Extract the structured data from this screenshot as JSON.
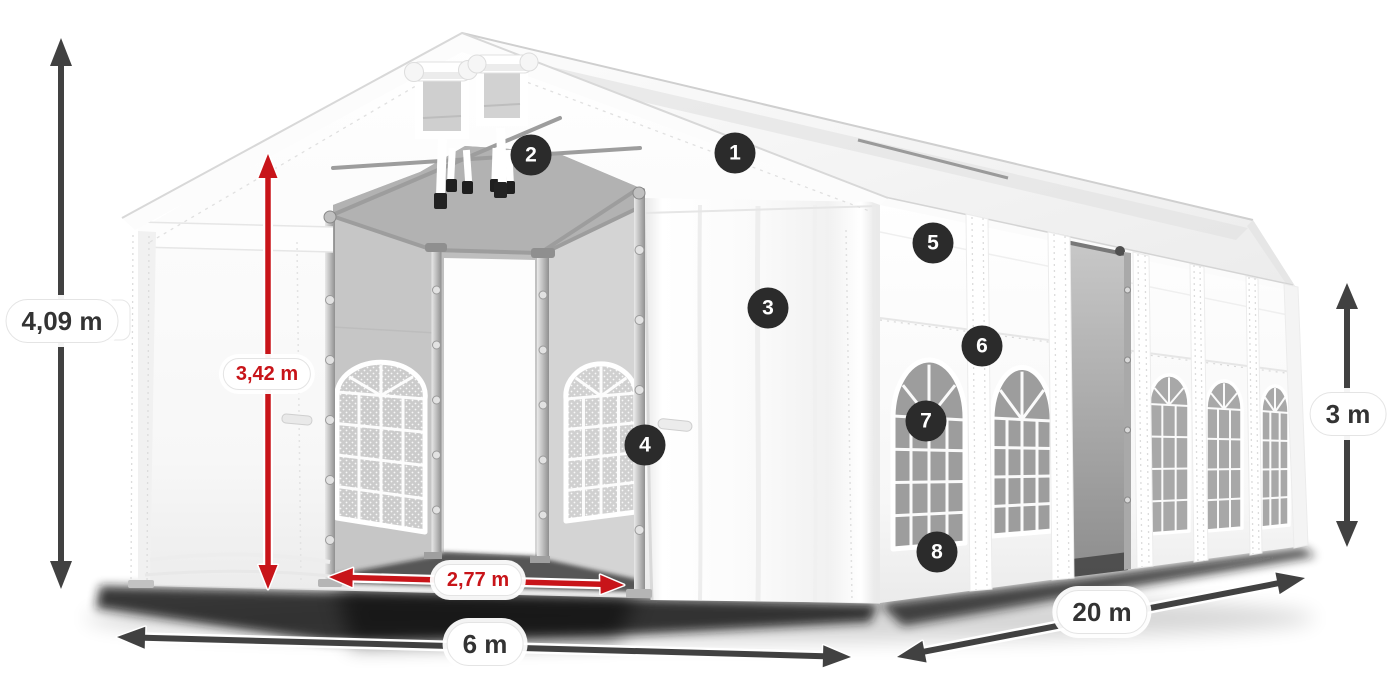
{
  "diagram": {
    "type": "product-dimension-diagram",
    "subject": "Party tent 6 x 20 m",
    "background": "#ffffff",
    "colors": {
      "outer_dimension_arrow": "#414141",
      "outer_dimension_text": "#333333",
      "inner_dimension_arrow": "#c81419",
      "inner_dimension_text": "#c81419",
      "label_pill_background": "#ffffff",
      "label_pill_border": "#e4e4e4",
      "callout_background": "#2b2b2b",
      "callout_text": "#ffffff",
      "tent_fabric": "#ffffff",
      "tent_interior": "#c9c9c9"
    },
    "dimensions": {
      "total_height": "4,09 m",
      "inner_height": "3,42 m",
      "entrance_width": "2,77 m",
      "width": "6 m",
      "length": "20 m",
      "side_height": "3 m"
    },
    "callouts": [
      {
        "number": "1"
      },
      {
        "number": "2"
      },
      {
        "number": "3"
      },
      {
        "number": "4"
      },
      {
        "number": "5"
      },
      {
        "number": "6"
      },
      {
        "number": "7"
      },
      {
        "number": "8"
      }
    ]
  }
}
